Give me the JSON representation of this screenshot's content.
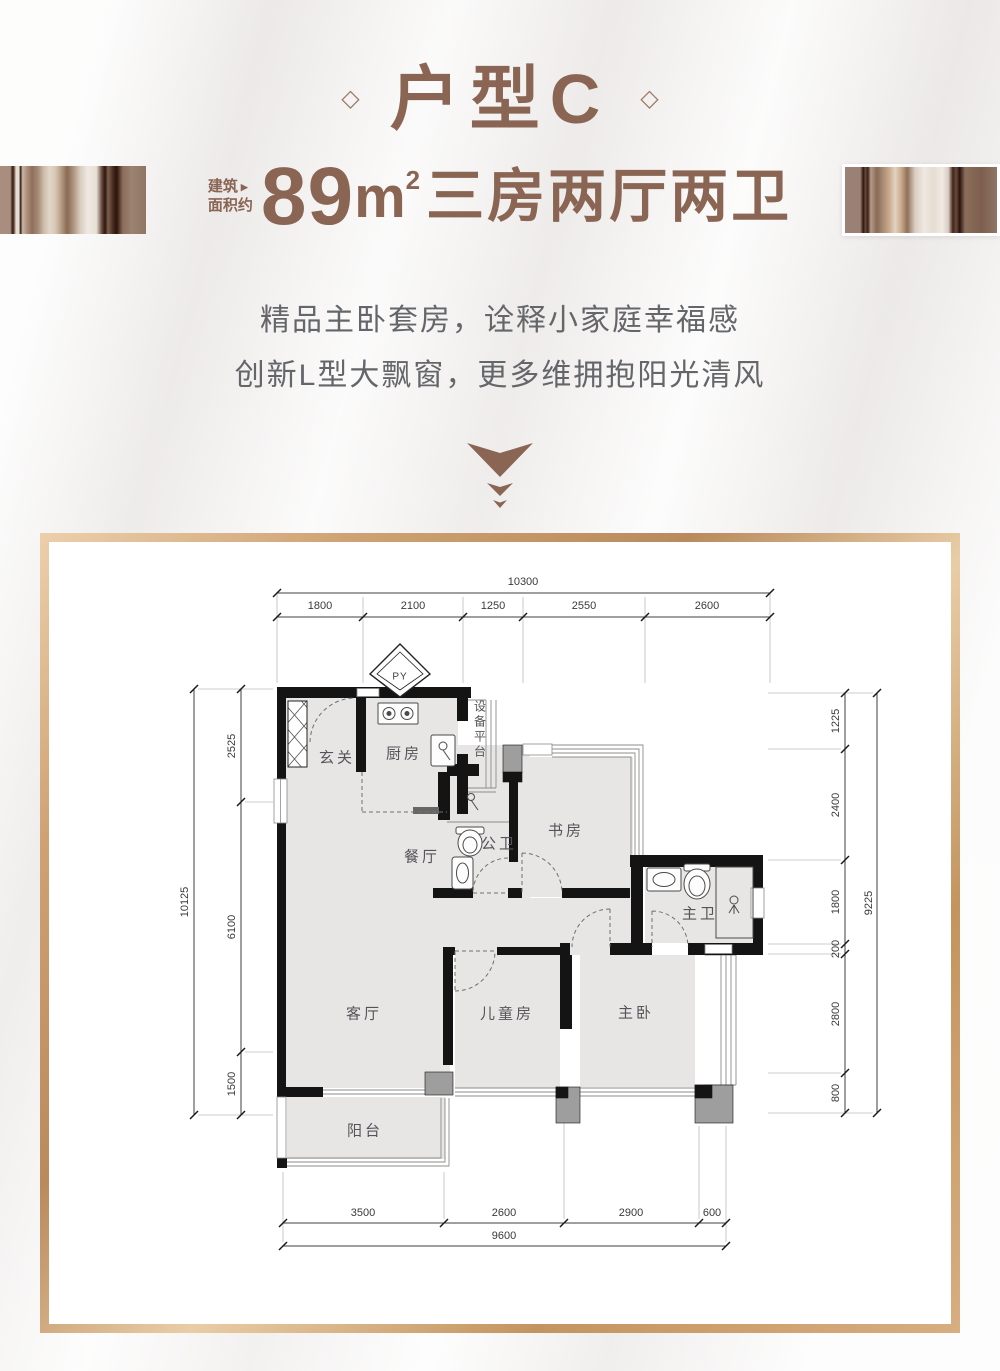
{
  "header": {
    "deco_diamond": "◇",
    "title": "户型C",
    "area_label_line1": "建筑",
    "area_label_line2": "面积约",
    "area_arrow": "▶",
    "area_number": "89",
    "area_unit_base": "m",
    "area_unit_sup": "2",
    "area_rooms": "三房两厅两卫",
    "tagline_1": "精品主卧套房，诠释小家庭幸福感",
    "tagline_2": "创新L型大飘窗，更多维拥抱阳光清风"
  },
  "floorplan": {
    "shaft_label": "PY",
    "rooms": [
      {
        "name": "entry",
        "label": "玄关"
      },
      {
        "name": "kitchen",
        "label": "厨房"
      },
      {
        "name": "equipment-platform",
        "label": "设备平台"
      },
      {
        "name": "dining",
        "label": "餐厅"
      },
      {
        "name": "public-bath",
        "label": "公卫"
      },
      {
        "name": "study",
        "label": "书房"
      },
      {
        "name": "master-bath",
        "label": "主卫"
      },
      {
        "name": "living",
        "label": "客厅"
      },
      {
        "name": "kids-room",
        "label": "儿童房"
      },
      {
        "name": "master-bedroom",
        "label": "主卧"
      },
      {
        "name": "balcony",
        "label": "阳台"
      }
    ],
    "dimensions": {
      "top_total": "10300",
      "top_segments": [
        "1800",
        "2100",
        "1250",
        "2550",
        "2600"
      ],
      "left_total": "10125",
      "left_segments": [
        "2525",
        "6100",
        "1500"
      ],
      "right_total": "9225",
      "right_segments": [
        "1225",
        "2400",
        "1800",
        "200",
        "2800",
        "800"
      ],
      "bottom_total": "9600",
      "bottom_segments": [
        "3500",
        "2600",
        "2900",
        "600"
      ]
    }
  },
  "colors": {
    "brand_brown": "#8a6553",
    "text_gray": "#64666a",
    "frame_gold": "#cfa273"
  }
}
